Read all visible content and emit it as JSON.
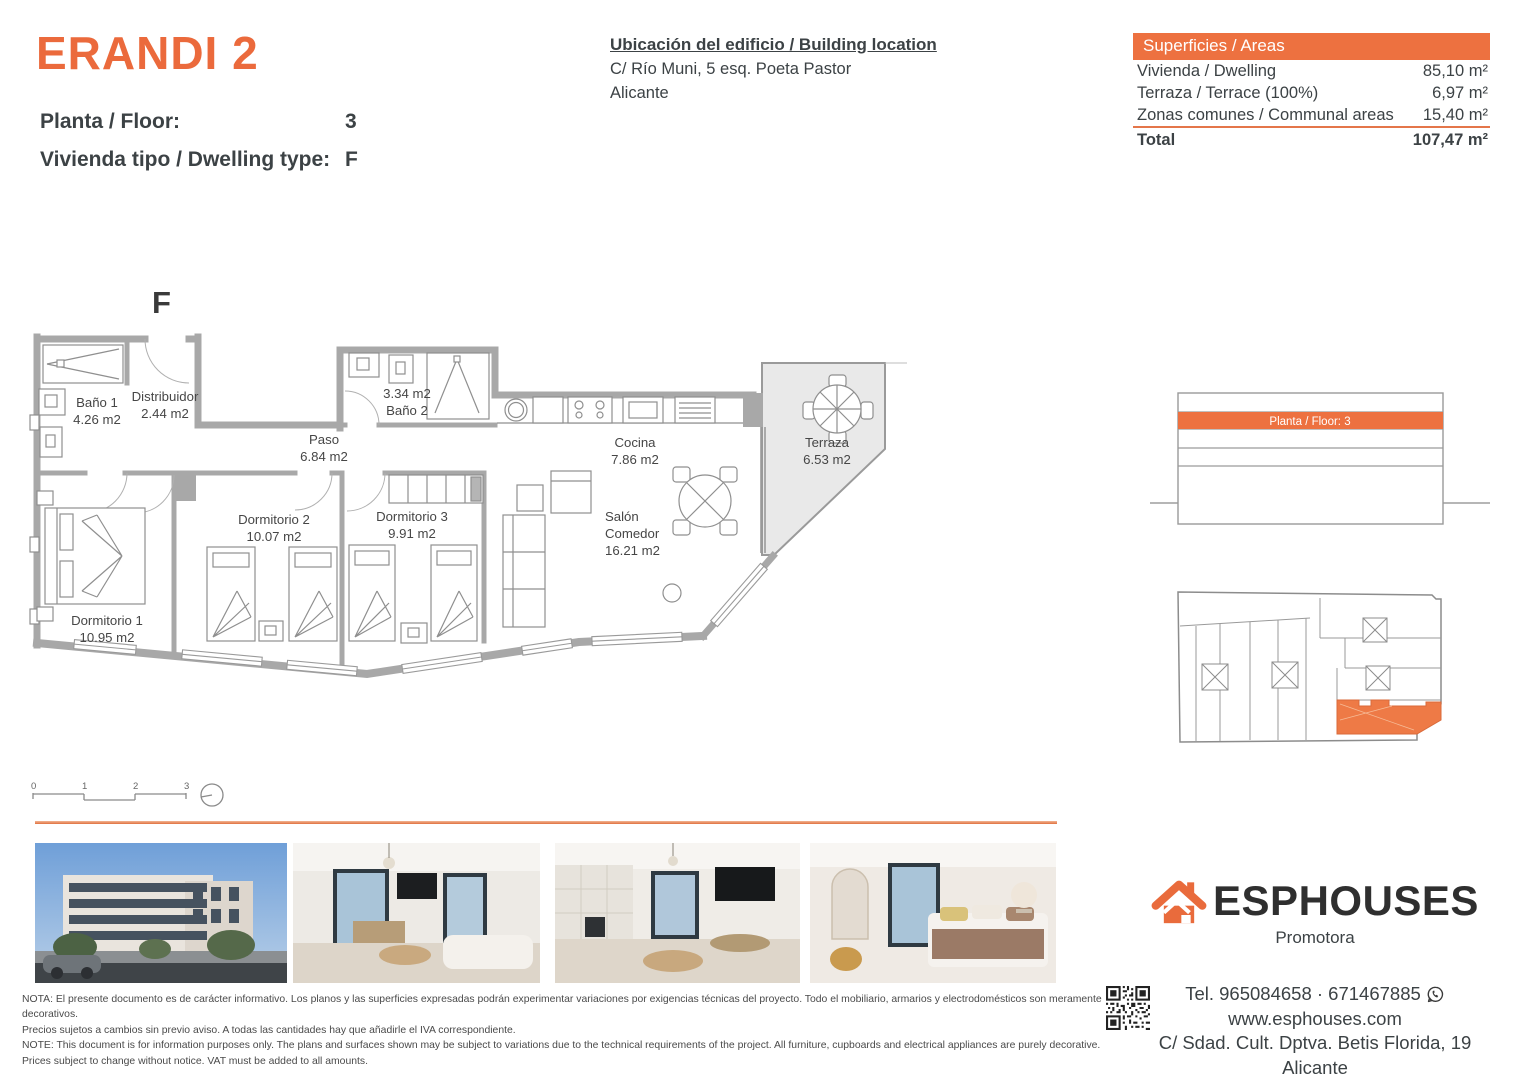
{
  "header": {
    "title": "ERANDI 2",
    "floor_label": "Planta / Floor:",
    "floor_value": "3",
    "dwelling_label": "Vivienda tipo / Dwelling type:",
    "dwelling_value": "F",
    "location": {
      "title": "Ubicación del edificio / Building location",
      "line1": "C/ Río Muni, 5 esq. Poeta Pastor",
      "line2": "Alicante"
    }
  },
  "areas": {
    "header": "Superficies / Areas",
    "rows": [
      {
        "label": "Vivienda / Dwelling",
        "value": "85,10 m²"
      },
      {
        "label": "Terraza / Terrace (100%)",
        "value": "6,97 m²"
      },
      {
        "label": "Zonas comunes / Communal areas",
        "value": "15,40 m²"
      }
    ],
    "total_label": "Total",
    "total_value": "107,47 m²"
  },
  "plan": {
    "type_letter": "F",
    "rooms": {
      "bano1": {
        "name": "Baño 1",
        "area": "4.26 m2"
      },
      "distribuidor": {
        "name": "Distribuidor",
        "area": "2.44 m2"
      },
      "paso": {
        "name": "Paso",
        "area": "6.84 m2"
      },
      "bano2": {
        "name": "Baño 2",
        "area": "3.34 m2"
      },
      "cocina": {
        "name": "Cocina",
        "area": "7.86 m2"
      },
      "terraza": {
        "name": "Terraza",
        "area": "6.53 m2"
      },
      "dorm1": {
        "name": "Dormitorio 1",
        "area": "10.95 m2"
      },
      "dorm2": {
        "name": "Dormitorio 2",
        "area": "10.07 m2"
      },
      "dorm3": {
        "name": "Dormitorio 3",
        "area": "9.91 m2"
      },
      "salon": {
        "name1": "Salón",
        "name2": "Comedor",
        "area": "16.21 m2"
      }
    },
    "scale_ticks": [
      "0",
      "1",
      "2",
      "3"
    ]
  },
  "elevation": {
    "floor_label": "Planta / Floor: 3"
  },
  "footer": {
    "disclaimer": [
      "NOTA: El presente documento es de carácter informativo. Los planos y las superficies expresadas podrán experimentar variaciones por exigencias técnicas del proyecto. Todo el mobiliario, armarios y electrodomésticos son meramente decorativos.",
      "Precios sujetos a cambios sin previo aviso. A todas las cantidades hay que añadirle el IVA correspondiente.",
      "NOTE: This document is for information purposes only. The plans and surfaces shown may be subject to variations due to the technical requirements of the project. All furniture, cupboards and electrical appliances are purely decorative.",
      "Prices subject to change without notice. VAT must be added to all amounts."
    ],
    "brand": {
      "name": "ESPHOUSES",
      "subtitle": "Promotora"
    },
    "contact": {
      "phone": "Tel. 965084658 · 671467885",
      "website": "www.esphouses.com",
      "address": "C/ Sdad. Cult. Dptva. Betis Florida, 19",
      "city": "Alicante"
    }
  },
  "colors": {
    "accent": "#eb6a3c",
    "accent_bar": "#ed7140",
    "wall_gray": "#a8a8a8",
    "text_dark": "#3c4245"
  }
}
